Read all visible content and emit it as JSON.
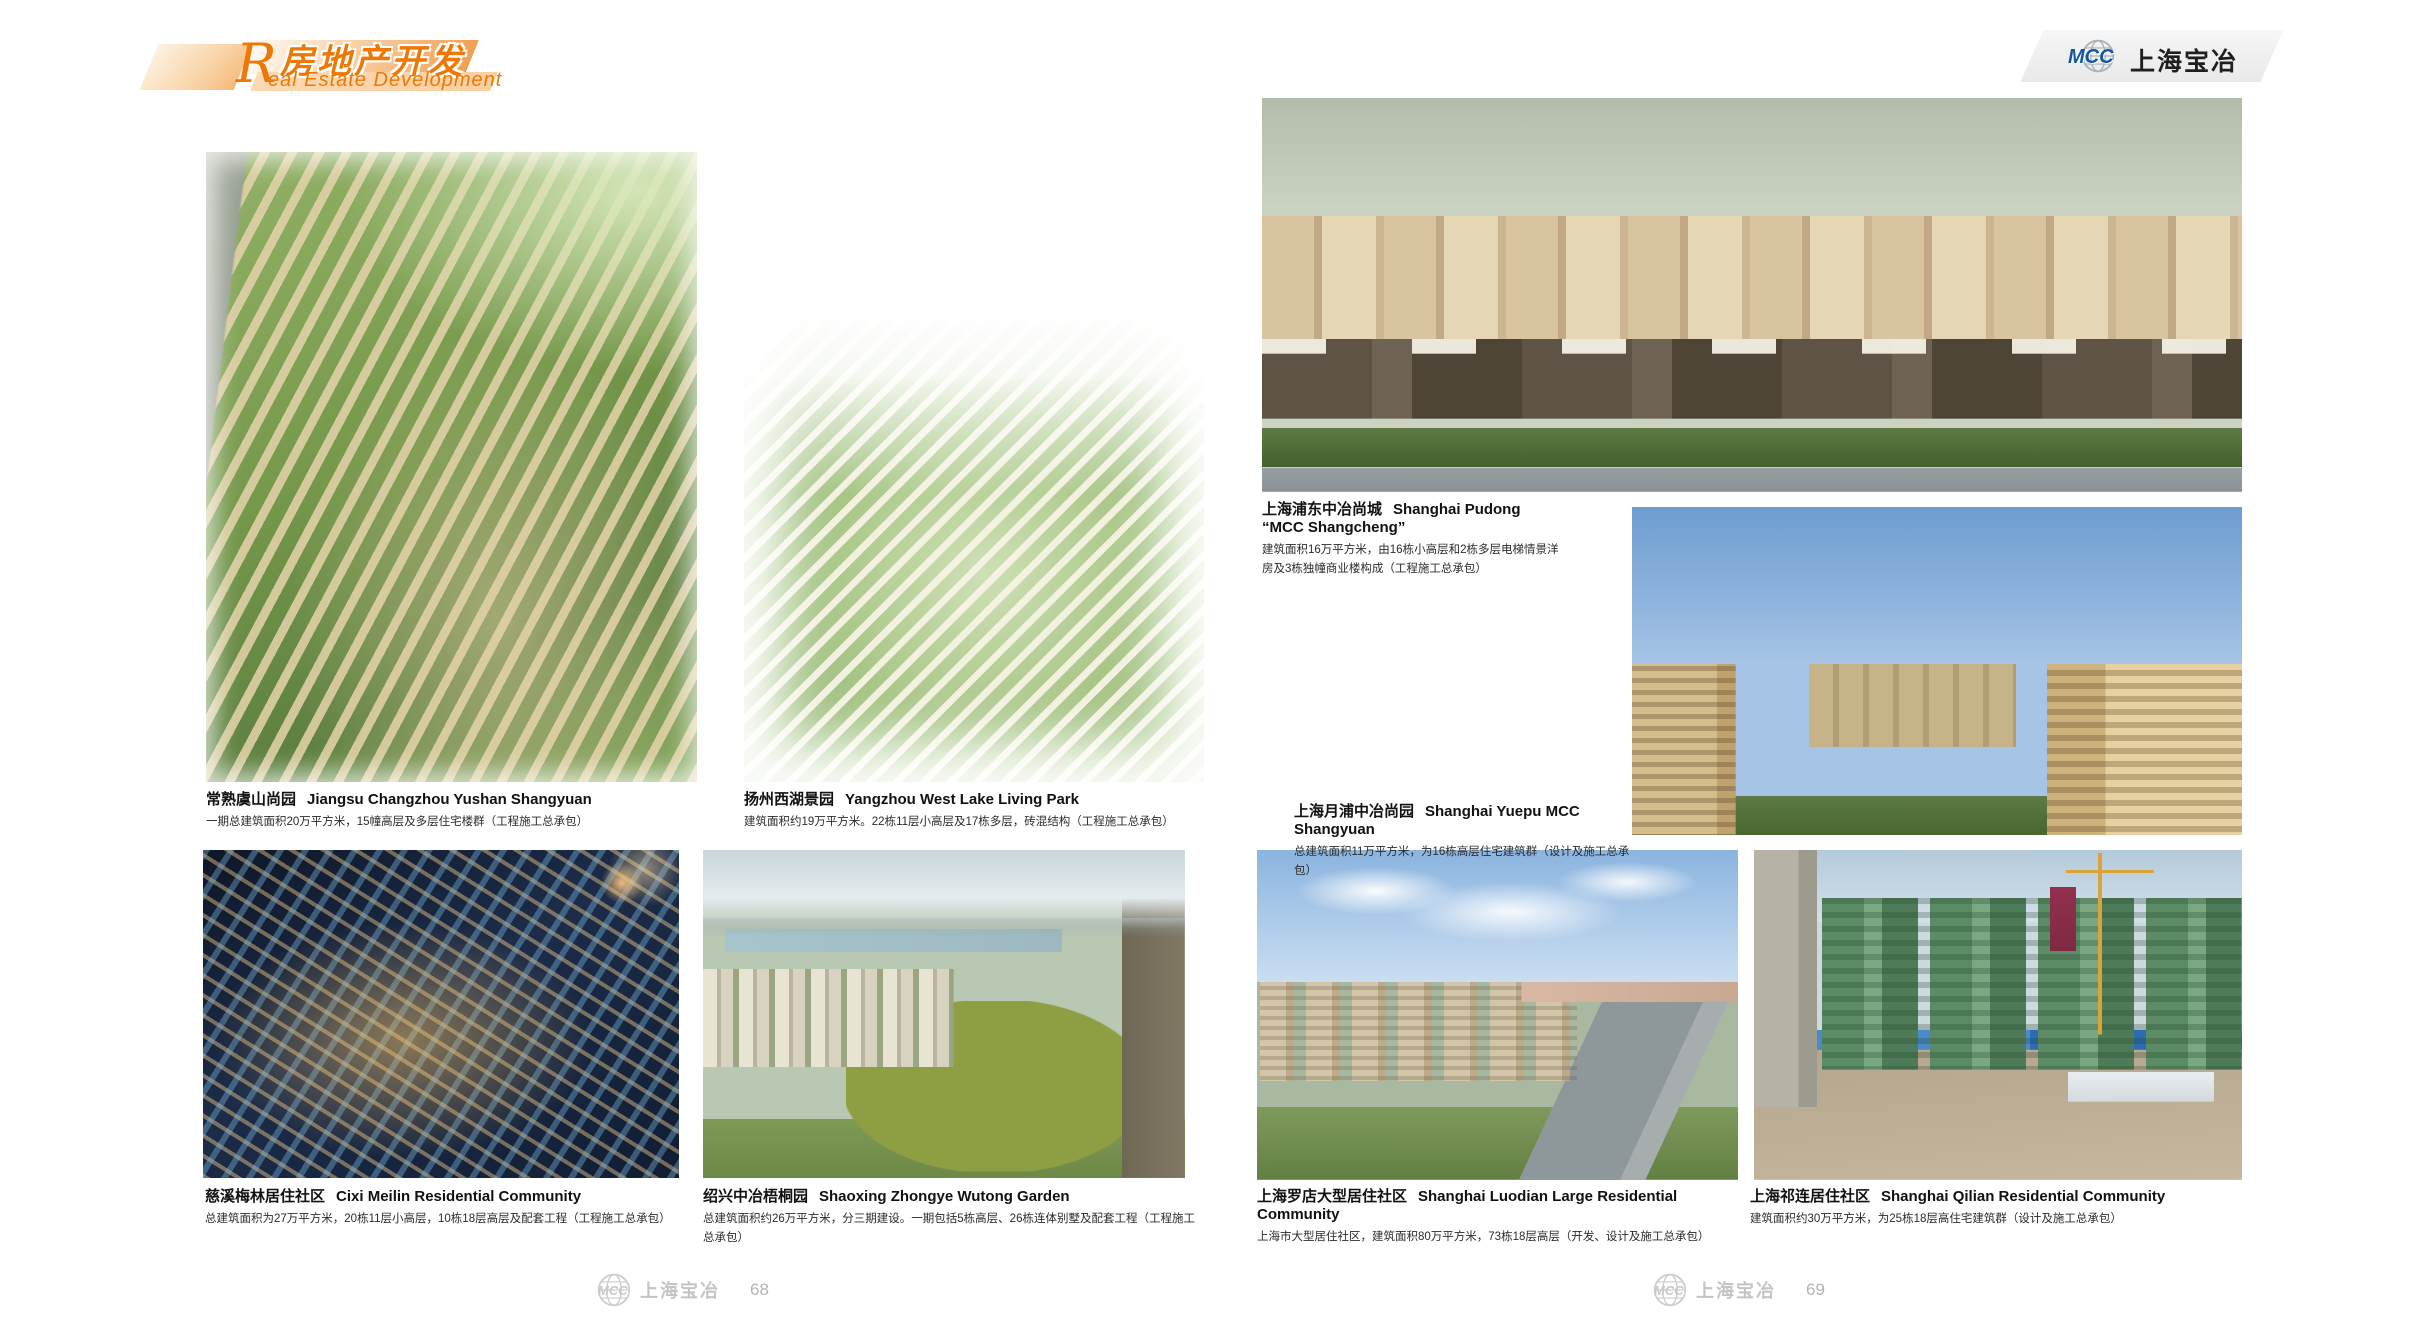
{
  "header": {
    "section_title_cn": "房地产开发",
    "section_title_en_initial": "R",
    "section_title_en_rest": "eal Estate Development",
    "brand_logo": "MCC",
    "brand_name": "上海宝冶"
  },
  "projects": [
    {
      "title_cn": "常熟虞山尚园",
      "title_en": "Jiangsu Changzhou Yushan Shangyuan",
      "desc": "一期总建筑面积20万平方米，15幢高层及多层住宅楼群（工程施工总承包）"
    },
    {
      "title_cn": "扬州西湖景园",
      "title_en": "Yangzhou West Lake Living Park",
      "desc": "建筑面积约19万平方米。22栋11层小高层及17栋多层，砖混结构（工程施工总承包）"
    },
    {
      "title_cn": "慈溪梅林居住社区",
      "title_en": "Cixi Meilin  Residential Community",
      "desc": "总建筑面积为27万平方米，20栋11层小高层，10栋18层高层及配套工程（工程施工总承包）"
    },
    {
      "title_cn": "绍兴中冶梧桐园",
      "title_en": "Shaoxing Zhongye Wutong Garden",
      "desc": "总建筑面积约26万平方米，分三期建设。一期包括5栋高层、26栋连体别墅及配套工程（工程施工总承包）"
    },
    {
      "title_cn": "上海浦东中冶尚城",
      "title_en": "Shanghai Pudong “MCC Shangcheng”",
      "desc": "建筑面积16万平方米，由16栋小高层和2栋多层电梯情景洋房及3栋独幢商业楼构成（工程施工总承包）"
    },
    {
      "title_cn": "上海月浦中冶尚园",
      "title_en": "Shanghai Yuepu MCC Shangyuan",
      "desc": "总建筑面积11万平方米，为16栋高层住宅建筑群（设计及施工总承包）"
    },
    {
      "title_cn": "上海罗店大型居住社区",
      "title_en": "Shanghai Luodian Large Residential Community",
      "desc": "上海市大型居住社区，建筑面积80万平方米，73栋18层高层（开发、设计及施工总承包）"
    },
    {
      "title_cn": "上海祁连居住社区",
      "title_en": "Shanghai Qilian Residential Community",
      "desc": "建筑面积约30万平方米，为25栋18层高住宅建筑群（设计及施工总承包）"
    }
  ],
  "footer": {
    "brand_logo": "MCC",
    "brand_name": "上海宝冶",
    "left_page_number": "68",
    "right_page_number": "69"
  },
  "colors": {
    "accent_orange": "#ee7804",
    "logo_blue": "#1456a0",
    "footer_gray": "#c4c4c4",
    "text_dark": "#1a1a1a"
  }
}
